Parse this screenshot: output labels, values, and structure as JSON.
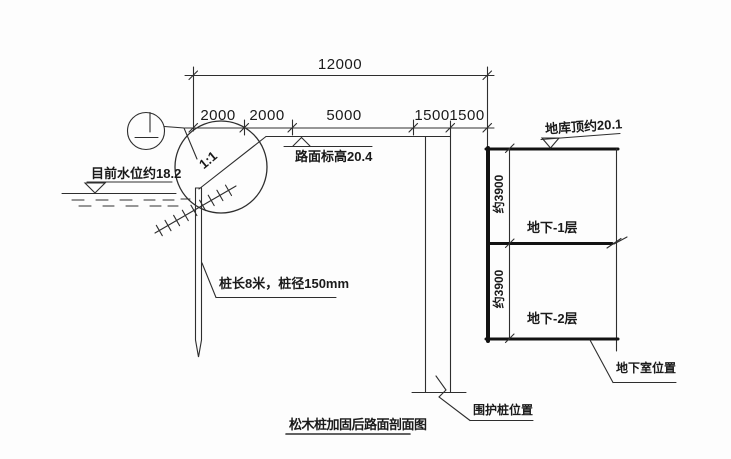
{
  "drawing": {
    "title": "松木桩加固后路面剖面图",
    "dimensions": {
      "total": "12000",
      "segments": [
        "2000",
        "2000",
        "5000",
        "1500",
        "1500"
      ],
      "floor_heights": [
        "约3900",
        "约3900"
      ]
    },
    "labels": {
      "water_level": "目前水位约18.2",
      "road_elevation": "路面标高20.4",
      "slope_ratio": "1:1",
      "pile_note": "桩长8米，桩径150mm",
      "garage_top": "地库顶约20.1",
      "basement_floor_1": "地下-1层",
      "basement_floor_2": "地下-2层",
      "basement_position": "地下室位置",
      "retaining_pile_position": "围护桩位置"
    },
    "colors": {
      "line": "#2e2e2e",
      "thick_line": "#121212",
      "background": "#fdfdfd",
      "text": "#1a1a1a"
    }
  }
}
